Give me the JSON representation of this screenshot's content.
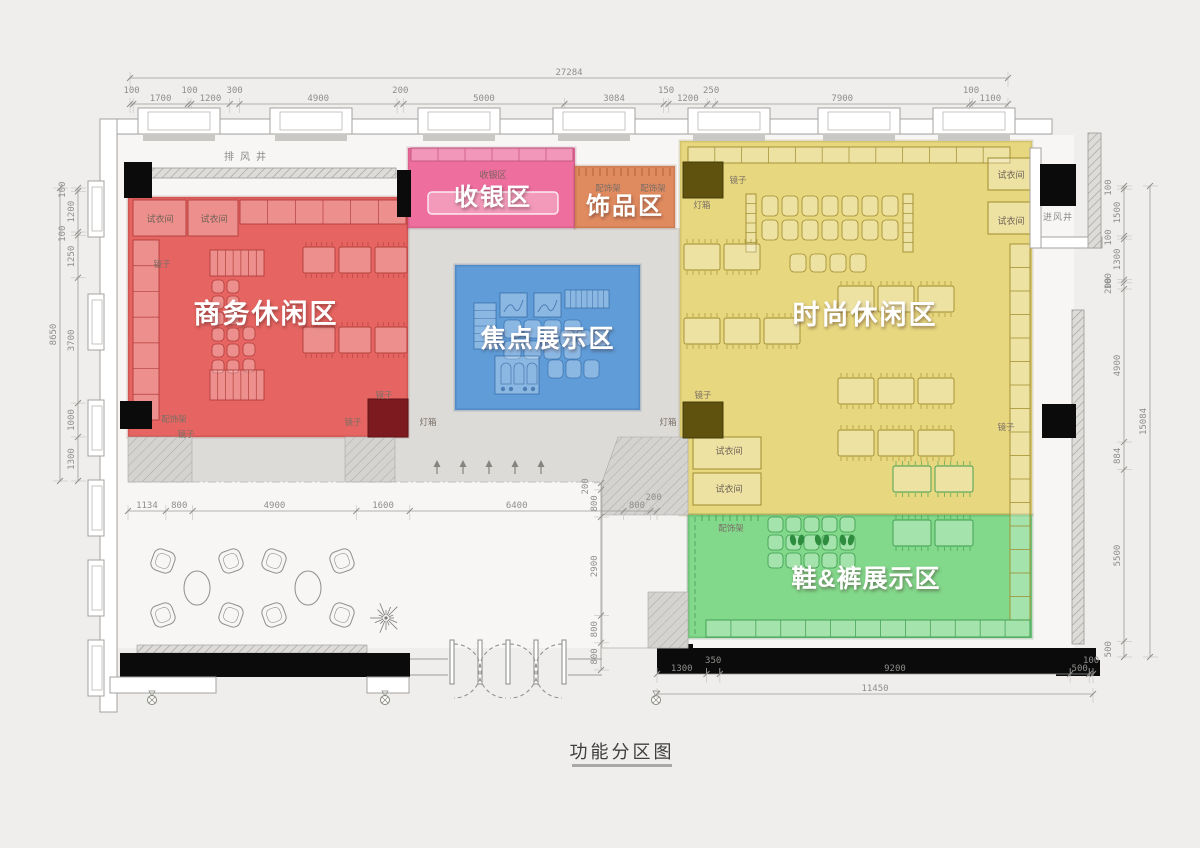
{
  "title": {
    "text": "功能分区图"
  },
  "zones": {
    "business": {
      "label": "商务休闲区",
      "color": "#e66461"
    },
    "cashier": {
      "label": "收银区",
      "color": "#ee6f9e"
    },
    "accessories": {
      "label": "饰品区",
      "color": "#e08a5f"
    },
    "focus": {
      "label": "焦点展示区",
      "color": "#5f9cd8"
    },
    "fashion": {
      "label": "时尚休闲区",
      "color": "#e7d77f"
    },
    "shoes": {
      "label": "鞋&裤展示区",
      "color": "#82d88b"
    }
  },
  "fixtures": {
    "fitting_room": "试衣间",
    "mirror": "镜子",
    "lightbox": "灯箱",
    "accessory_rack": "配饰架",
    "cashier_small": "收银区",
    "exhaust_shaft": "排风井",
    "intake_shaft": "进风井"
  },
  "dims": {
    "top_total": [
      27284
    ],
    "top_chain": [
      100,
      1700,
      100,
      1200,
      300,
      4900,
      200,
      5000,
      3084,
      150,
      1200,
      250,
      7900,
      100,
      1100
    ],
    "left_total": [
      8650
    ],
    "left_chain": [
      100,
      1200,
      100,
      1250,
      3700,
      1000,
      1300
    ],
    "right_total": [
      15084
    ],
    "right_chain": [
      100,
      1500,
      100,
      1300,
      100,
      200,
      4900,
      884,
      5500,
      500
    ],
    "mid_chain": [
      1134,
      800,
      4900,
      1600,
      6400,
      800,
      200
    ],
    "aisle_chain": [
      200,
      800,
      2900,
      800,
      800
    ],
    "bottom_chain": [
      1300,
      350,
      9200,
      500,
      100
    ],
    "bottom_total": [
      11450
    ]
  }
}
